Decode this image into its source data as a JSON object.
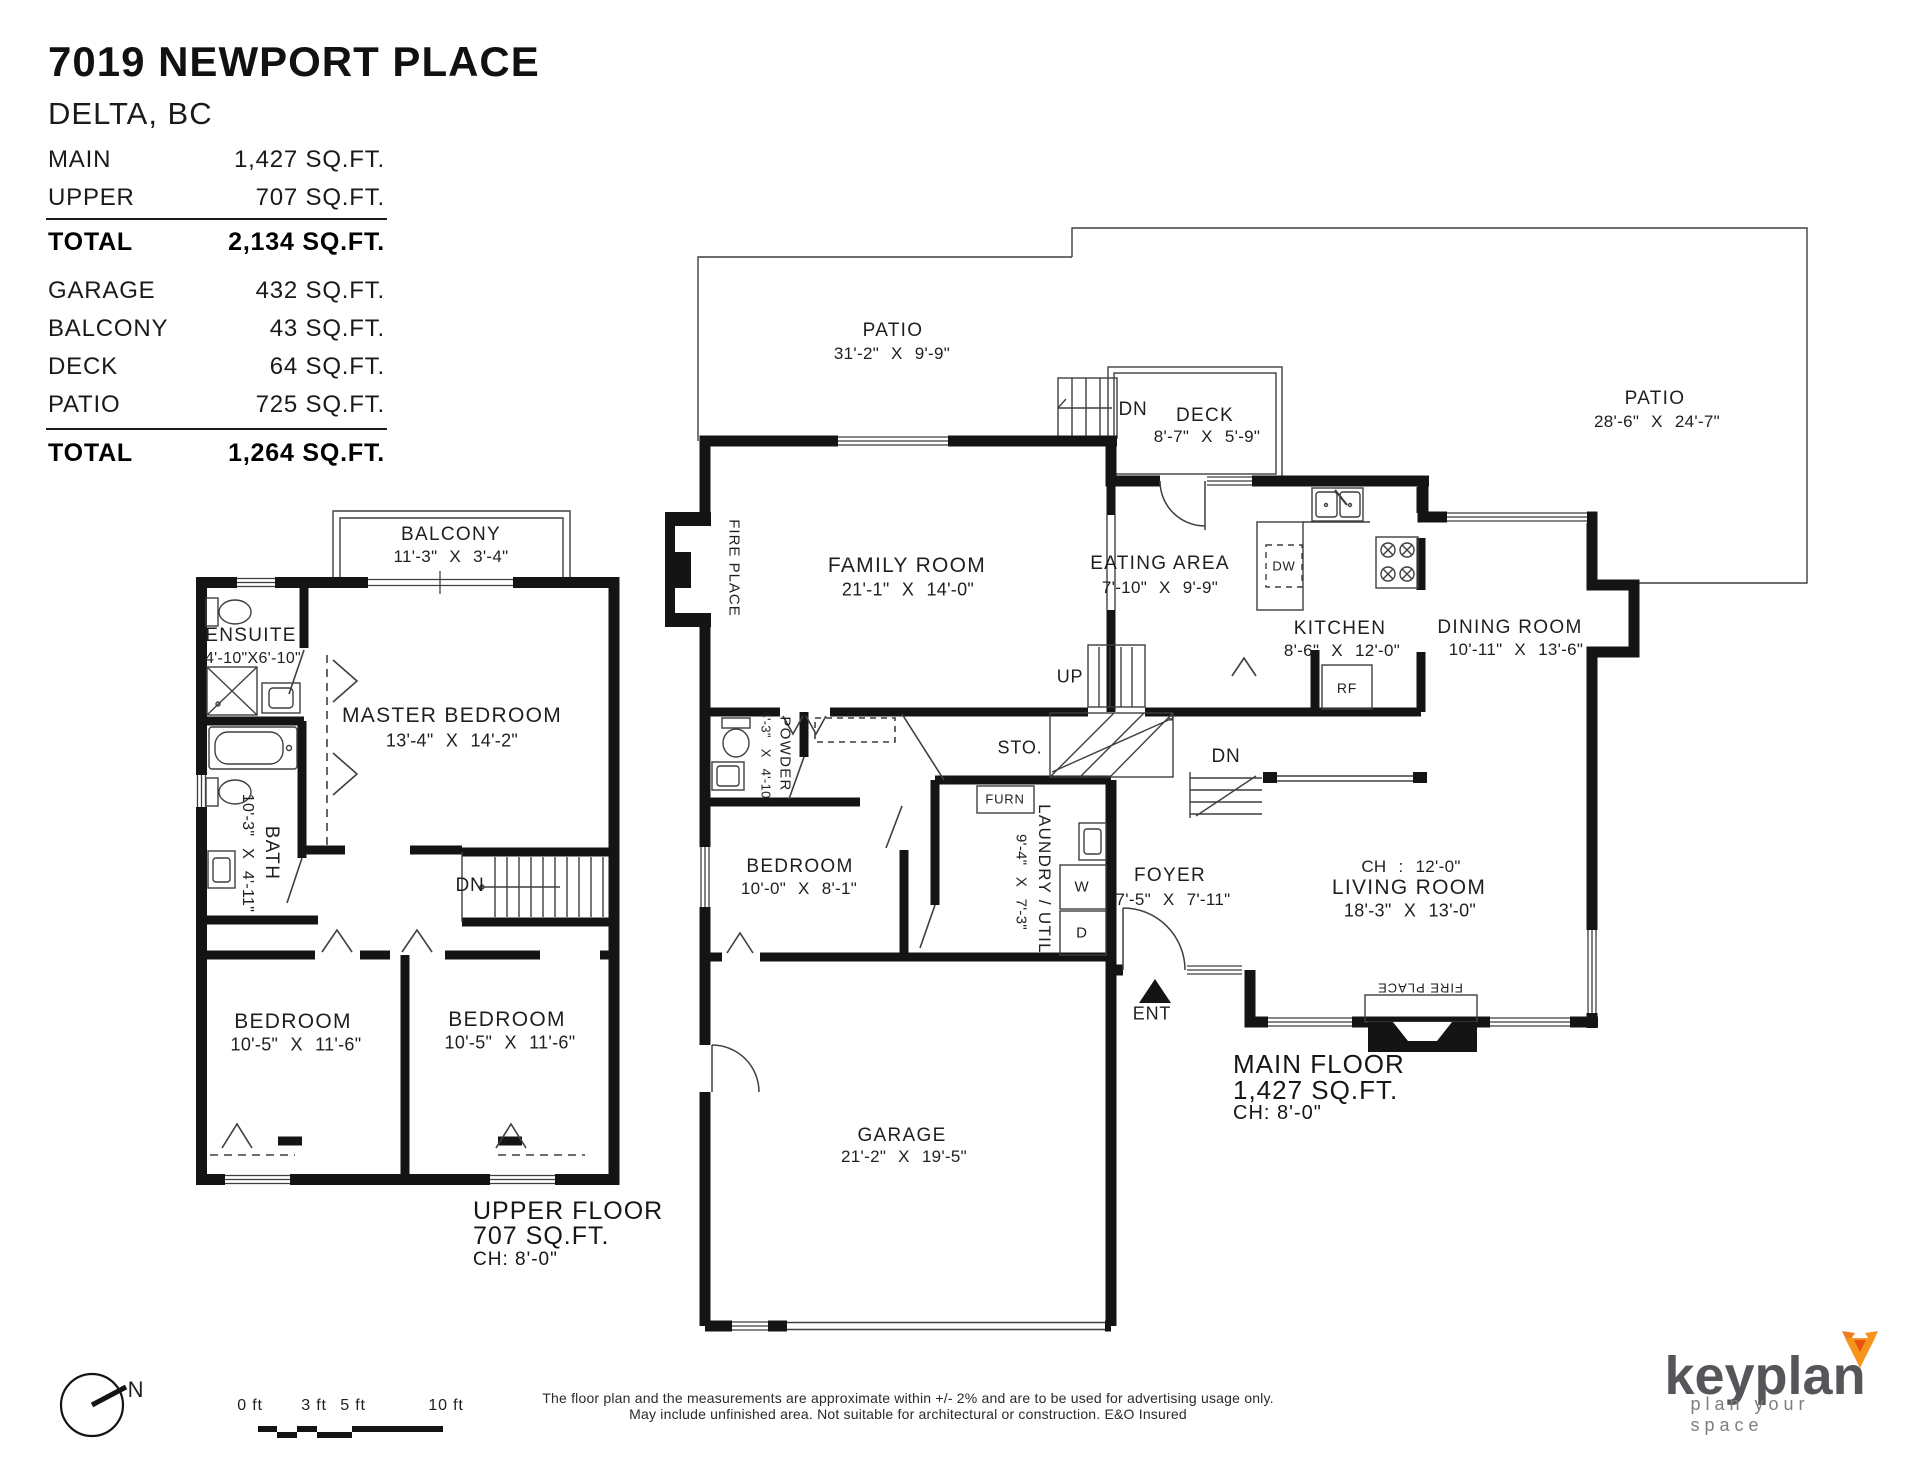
{
  "header": {
    "title": "7019 NEWPORT PLACE",
    "subtitle": "DELTA, BC",
    "rows": [
      {
        "label": "MAIN",
        "value": "1,427 SQ.FT."
      },
      {
        "label": "UPPER",
        "value": "707 SQ.FT."
      },
      {
        "label": "TOTAL",
        "value": "2,134 SQ.FT."
      },
      {
        "label": "GARAGE",
        "value": "432 SQ.FT."
      },
      {
        "label": "BALCONY",
        "value": "43 SQ.FT."
      },
      {
        "label": "DECK",
        "value": "64 SQ.FT."
      },
      {
        "label": "PATIO",
        "value": "725 SQ.FT."
      },
      {
        "label": "TOTAL",
        "value": "1,264 SQ.FT."
      }
    ]
  },
  "upper": {
    "balcony_name": "BALCONY",
    "balcony_dims": "11'-3\" X 3'-4\"",
    "ensuite_name": "ENSUITE",
    "ensuite_dims": "4'-10\"X6'-10\"",
    "master_name": "MASTER BEDROOM",
    "master_dims": "13'-4\" X 14'-2\"",
    "bath_name": "BATH",
    "bath_dims": "10'-3\" X 4'-11\"",
    "dn": "DN",
    "bedroom1_name": "BEDROOM",
    "bedroom1_dims": "10'-5\" X 11'-6\"",
    "bedroom2_name": "BEDROOM",
    "bedroom2_dims": "10'-5\" X 11'-6\"",
    "caption": [
      "UPPER FLOOR",
      "707 SQ.FT.",
      "CH: 8'-0\""
    ]
  },
  "main": {
    "patio_top_name": "PATIO",
    "patio_top_dims": "31'-2\" X 9'-9\"",
    "deck_name": "DECK",
    "deck_dims": "8'-7\" X 5'-9\"",
    "deck_dn": "DN",
    "patio_right_name": "PATIO",
    "patio_right_dims": "28'-6\" X 24'-7\"",
    "family_name": "FAMILY ROOM",
    "family_dims": "21'-1\" X 14'-0\"",
    "fireplace_family": "FIRE PLACE",
    "fireplace_living": "FIRE PLACE",
    "eating_name": "EATING AREA",
    "eating_dims": "7'-10\" X 9'-9\"",
    "kitchen_name": "KITCHEN",
    "kitchen_dims": "8'-6\" X 12'-0\"",
    "dw": "DW",
    "rf": "RF",
    "dining_name": "DINING ROOM",
    "dining_dims": "10'-11\" X 13'-6\"",
    "up": "UP",
    "sto": "STO.",
    "furn": "FURN",
    "washer": "W",
    "dryer": "D",
    "laundry_name": "LAUNDRY / UTIL.",
    "laundry_dims": "9'-4\" X 7'-3\"",
    "powder_name": "POWDER",
    "powder_dims": "4'-3\" X 4'-10\"",
    "bedroom_name": "BEDROOM",
    "bedroom_dims": "10'-0\" X 8'-1\"",
    "foyer_name": "FOYER",
    "foyer_dims": "7'-5\" X 7'-11\"",
    "foyer_dn": "DN",
    "ent": "ENT",
    "living_ch": "CH : 12'-0\"",
    "living_name": "LIVING ROOM",
    "living_dims": "18'-3\" X 13'-0\"",
    "garage_name": "GARAGE",
    "garage_dims": "21'-2\" X 19'-5\"",
    "caption": [
      "MAIN FLOOR",
      "1,427 SQ.FT.",
      "CH: 8'-0\""
    ]
  },
  "footer": {
    "north": "N",
    "scale_labels": [
      "0 ft",
      "3 ft",
      "5 ft",
      "10 ft"
    ],
    "disclaimer1": "The floor plan and the measurements are approximate within +/- 2% and are to be used for advertising usage only.",
    "disclaimer2": "May include unfinished area. Not suitable for architectural or construction. E&O Insured",
    "logo_text": "keyplan",
    "logo_tagline": "plan your space"
  },
  "colors": {
    "wall": "#141414",
    "thin_line": "#3f3f3f",
    "logo_text": "#55565a",
    "logo_tagline": "#7d7e82",
    "fox_orange": "#f7941e",
    "fox_dark": "#e8540f"
  }
}
